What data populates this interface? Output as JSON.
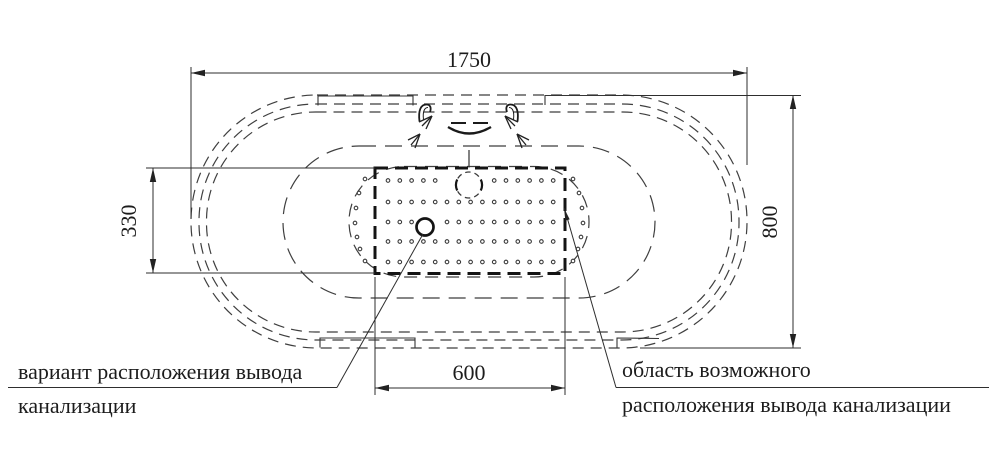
{
  "drawing_title": "bathtub-top-view-installation-diagram",
  "dimensions": {
    "overall_length": "1750",
    "overall_width": "800",
    "drain_zone_length": "600",
    "drain_zone_width": "330"
  },
  "labels": {
    "variant_line1": "вариант расположения вывода",
    "variant_line2": "канализации",
    "area_line1": "область возможного",
    "area_line2": "расположения вывода канализации"
  },
  "colors": {
    "background": "#ffffff",
    "line_thin": "#2e2e2e",
    "line_dashed": "#3f3f3f",
    "line_bold": "#141414",
    "text": "#1c1c1c"
  },
  "perforation": {
    "dot_radius": 1.8,
    "grid": {
      "x_start": 388,
      "step": 11.8,
      "count": 15,
      "rows": [
        {
          "y": 180.5,
          "skip_center": 469,
          "skip_half": 24
        },
        {
          "y": 202,
          "skip_center": 0,
          "skip_half": 0
        },
        {
          "y": 222,
          "skip_center": 425,
          "skip_half": 11
        },
        {
          "y": 241.5,
          "skip_center": 0,
          "skip_half": 0
        },
        {
          "y": 262,
          "skip_center": 0,
          "skip_half": 0
        }
      ]
    },
    "arc_dots_left": [
      [
        365,
        179
      ],
      [
        359,
        193
      ],
      [
        356,
        208
      ],
      [
        355,
        223
      ],
      [
        357,
        237
      ],
      [
        360,
        249
      ],
      [
        365,
        261
      ]
    ],
    "arc_dots_right": [
      [
        573,
        179
      ],
      [
        579,
        193
      ],
      [
        582,
        208
      ],
      [
        583,
        223
      ],
      [
        581,
        237
      ],
      [
        578,
        249
      ],
      [
        573,
        261
      ]
    ]
  }
}
